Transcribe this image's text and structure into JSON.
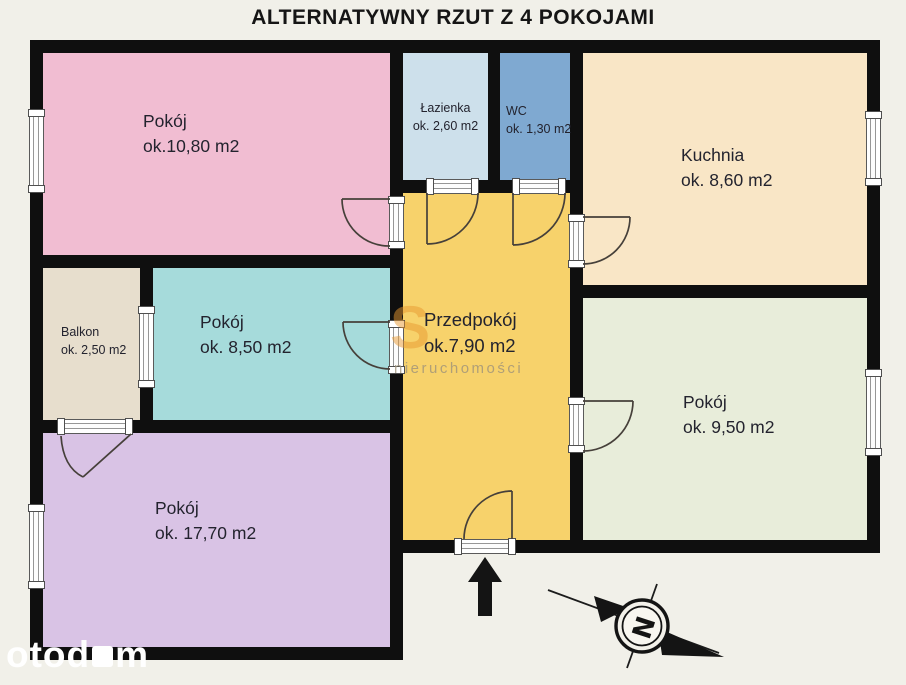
{
  "title": "ALTERNATYWNY RZUT Z 4 POKOJAMI",
  "rooms": [
    {
      "id": "pokoj-1",
      "name": "Pokój",
      "area": "ok.10,80  m2",
      "color": "#f1bdd2"
    },
    {
      "id": "lazienka",
      "name": "Łazienka",
      "area": "ok. 2,60 m2",
      "color": "#cde0eb"
    },
    {
      "id": "wc",
      "name": "WC",
      "area": "ok. 1,30 m2",
      "color": "#7fa9d1"
    },
    {
      "id": "kuchnia",
      "name": "Kuchnia",
      "area": "ok. 8,60 m2",
      "color": "#f9e6c6"
    },
    {
      "id": "przedpokoj",
      "name": "Przedpokój",
      "area": "ok.7,90 m2",
      "color": "#f7d26b"
    },
    {
      "id": "balkon",
      "name": "Balkon",
      "area": "ok. 2,50 m2",
      "color": "#e7decd"
    },
    {
      "id": "pokoj-2",
      "name": "Pokój",
      "area": "ok. 8,50 m2",
      "color": "#a6dbdb"
    },
    {
      "id": "pokoj-3",
      "name": "Pokój",
      "area": "ok. 9,50 m2",
      "color": "#e8edda"
    },
    {
      "id": "pokoj-4",
      "name": "Pokój",
      "area": "ok. 17,70 m2",
      "color": "#d9c3e5"
    }
  ],
  "compass": {
    "letter": "N"
  },
  "watermarks": {
    "agency_logo_letter": "S",
    "agency_text": "nieruchomości",
    "portal_part1": "otod",
    "portal_part2": "m"
  },
  "colors": {
    "wall": "#0f0f0f",
    "background": "#f1f0e9",
    "line": "#46403a",
    "arrow": "#141414"
  }
}
